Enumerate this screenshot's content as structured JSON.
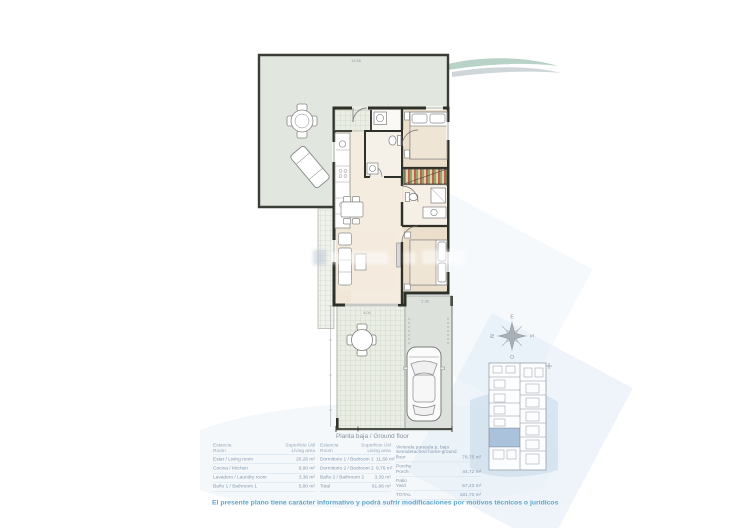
{
  "plan": {
    "title_label": "Planta baja / Ground floor",
    "dims": {
      "top_width": "13.55",
      "porch_width": "4.00",
      "driveway_width": "2.38"
    }
  },
  "compass": {
    "north": "N",
    "south": "S",
    "east": "E",
    "west": "O"
  },
  "table": {
    "header": {
      "room_1": "Estancia",
      "room_2": "Room",
      "area_1": "Superficie Útil",
      "area_2": "Living area"
    },
    "group1": {
      "rows": [
        {
          "l": "Estar / Living room",
          "v": "20,26 m²"
        },
        {
          "l": "Cocina / Kitchen",
          "v": "8,90 m²"
        },
        {
          "l": "Lavadero / Laundry room",
          "v": "3,36 m²"
        },
        {
          "l": "Baño 1 / Bathroom 1",
          "v": "5,80 m²"
        }
      ]
    },
    "group2": {
      "rows": [
        {
          "l": "Dormitorio 1 / Bedroom 1",
          "v": "11,66 m²"
        },
        {
          "l": "Dormitorio 2 / Bedroom 2",
          "v": "9,76 m²"
        },
        {
          "l": "Baño 2 / Bathroom 2",
          "v": "3,39 m²"
        },
        {
          "l": "Total",
          "v": "61,96 m²"
        }
      ]
    },
    "group3": {
      "rows": [
        {
          "l1": "Vivienda pareada p. baja",
          "l2": "Semidetached home-ground floor",
          "v": "79,75 m²"
        },
        {
          "l1": "Porche",
          "l2": "Porch",
          "v": "44,72 m²"
        },
        {
          "l1": "Patio",
          "l2": "Yard",
          "v": "57,23 m²"
        },
        {
          "l1": "TOTAL",
          "l2": "",
          "v": "181,70 m²"
        }
      ]
    }
  },
  "disclaimer": "El presente plano tiene carácter informativo y podrá sufrir modificaciones por motivos técnicos o jurídicos",
  "colors": {
    "accent_blue": "#5fa5cb",
    "table_text": "#8699ae",
    "terrace_green": "#e1e6df",
    "interior_beige": "#f1e7d8",
    "highlight_unit": "#a3bcd9",
    "wall_dark": "#2e3129"
  }
}
